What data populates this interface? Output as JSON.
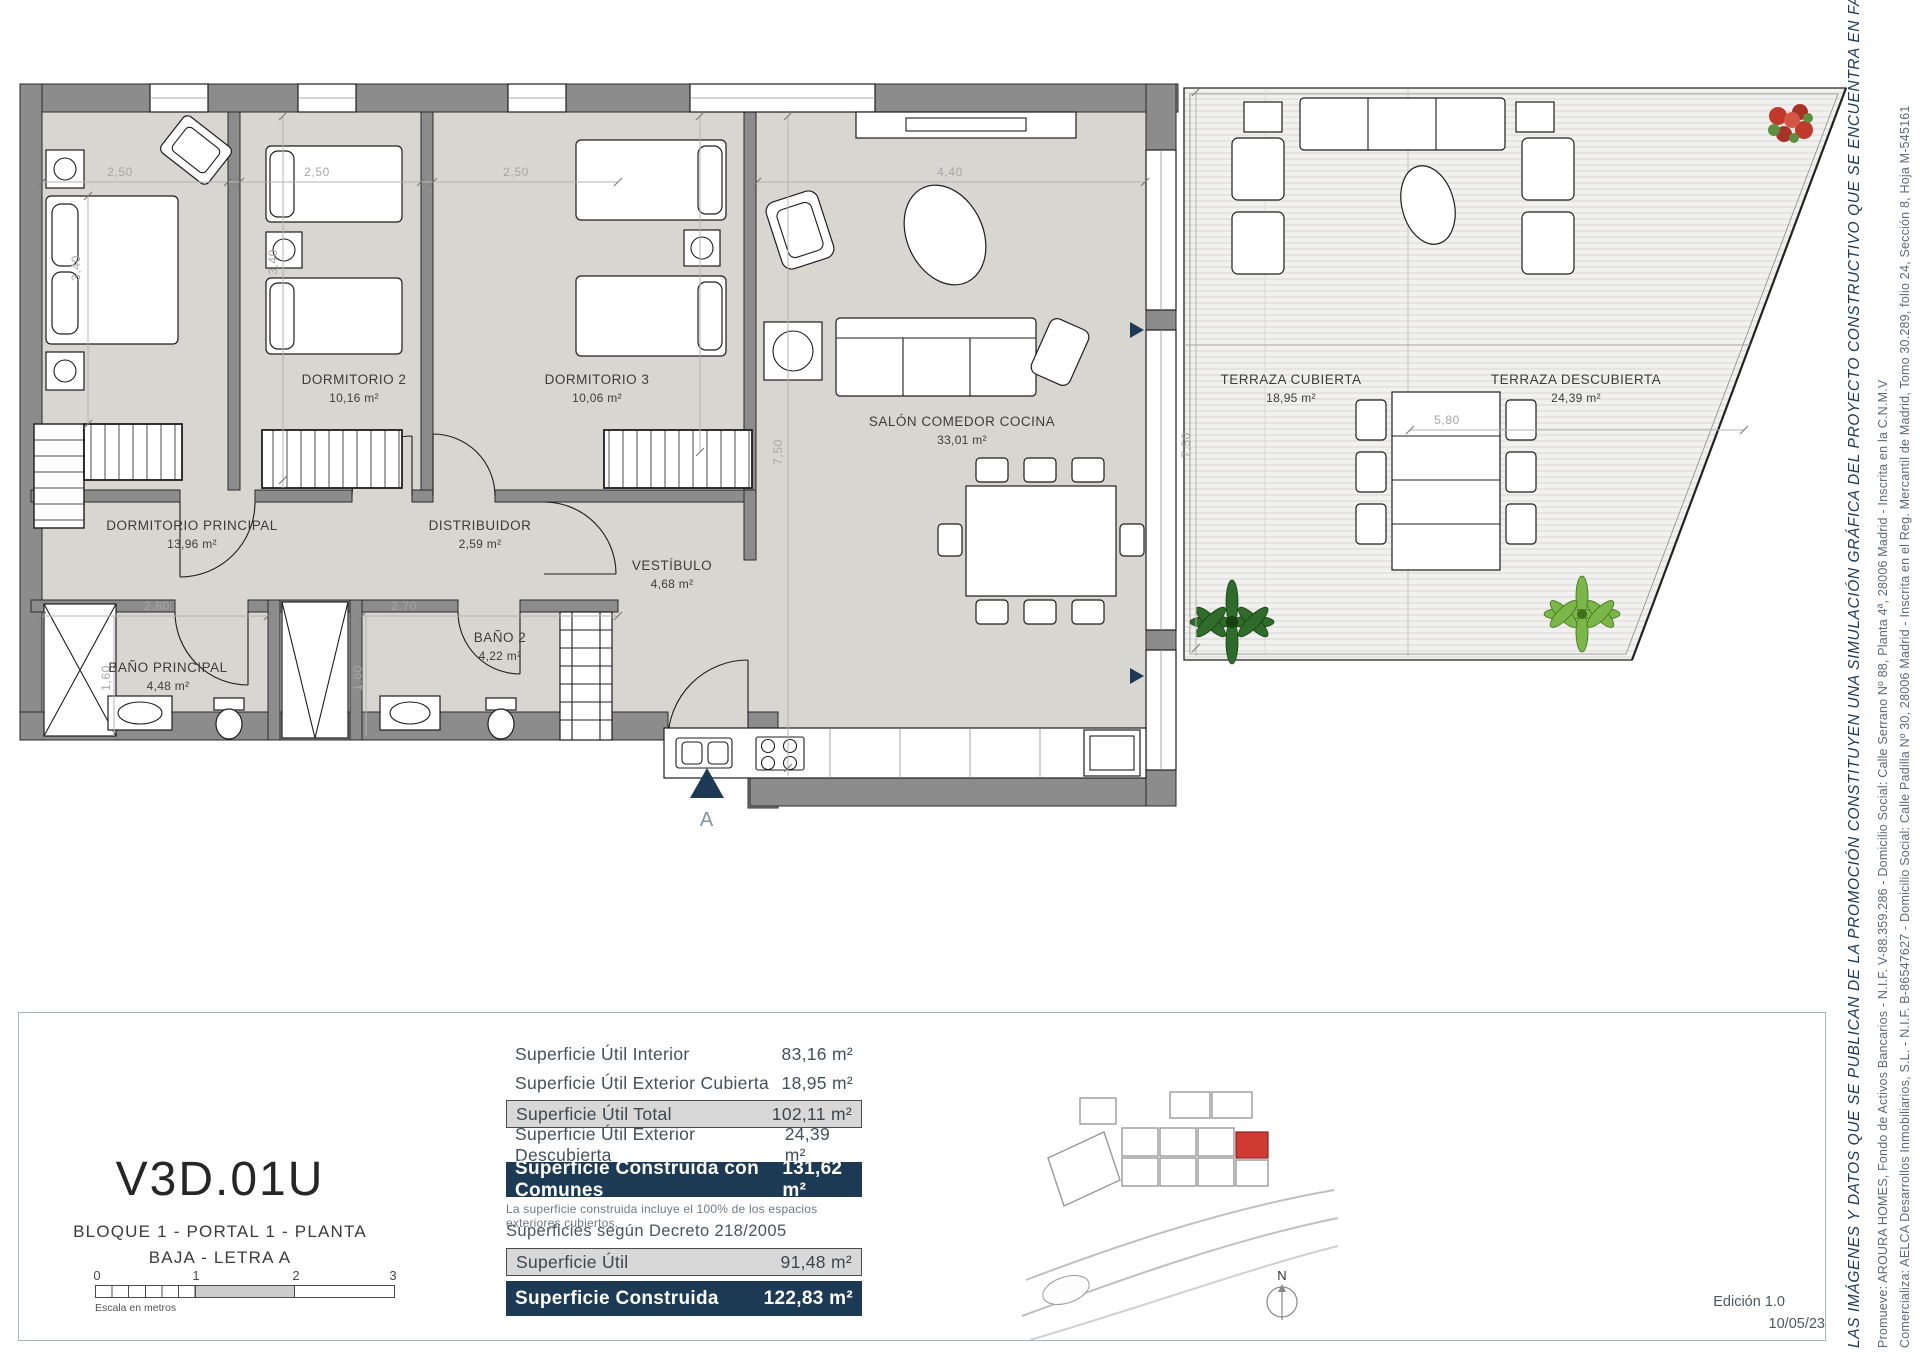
{
  "sheet": {
    "unit_code": "V3D.01U",
    "subtitle_line1": "BLOQUE 1 - PORTAL 1 - PLANTA",
    "subtitle_line2": "BAJA - LETRA A",
    "edition": "Edición 1.0",
    "date": "10/05/23"
  },
  "plan": {
    "rooms": [
      {
        "name": "DORMITORIO PRINCIPAL",
        "area": "13,96 m²"
      },
      {
        "name": "DORMITORIO 2",
        "area": "10,16 m²"
      },
      {
        "name": "DORMITORIO 3",
        "area": "10,06 m²"
      },
      {
        "name": "SALÓN COMEDOR COCINA",
        "area": "33,01 m²"
      },
      {
        "name": "DISTRIBUIDOR",
        "area": "2,59 m²"
      },
      {
        "name": "VESTÍBULO",
        "area": "4,68 m²"
      },
      {
        "name": "BAÑO PRINCIPAL",
        "area": "4,48 m²"
      },
      {
        "name": "BAÑO 2",
        "area": "4,22 m²"
      },
      {
        "name": "TERRAZA CUBIERTA",
        "area": "18,95 m²"
      },
      {
        "name": "TERRAZA DESCUBIERTA",
        "area": "24,39 m²"
      }
    ],
    "dims": {
      "d1": "2,50",
      "d2": "2,50",
      "d3": "2,50",
      "d4": "3,40",
      "d5": "3,40",
      "d6": "4,40",
      "d7": "7,50",
      "d8": "7,50",
      "d9": "5,80",
      "d10": "2,80",
      "d11": "2,70",
      "d12": "1,60",
      "d13": "1,60"
    },
    "entrance_label": "A"
  },
  "scalebar": {
    "ticks": [
      "0",
      "1",
      "2",
      "3"
    ],
    "caption": "Escala en metros"
  },
  "areas_table": {
    "rows": [
      {
        "label": "Superficie Útil Interior",
        "value": "83,16 m²"
      },
      {
        "label": "Superficie Útil Exterior Cubierta",
        "value": "18,95 m²"
      },
      {
        "label": "Superficie Útil Total",
        "value": "102,11 m²"
      },
      {
        "label": "Superficie Útil Exterior Descubierta",
        "value": "24,39 m²"
      },
      {
        "label": "Superficie Construida con Comunes",
        "value": "131,62 m²"
      }
    ],
    "footnote": "La superficie construida incluye el 100% de los espacios exteriores cubiertos."
  },
  "decreto_table": {
    "title": "Superficies según Decreto 218/2005",
    "rows": [
      {
        "label": "Superficie Útil",
        "value": "91,48 m²"
      },
      {
        "label": "Superficie Construida",
        "value": "122,83 m²"
      }
    ]
  },
  "compass": {
    "north": "N"
  },
  "legal": {
    "disclaimer": "LAS IMÁGENES Y DATOS QUE SE PUBLICAN DE LA PROMOCIÓN CONSTITUYEN UNA SIMULACIÓN GRÁFICA DEL PROYECTO CONSTRUCTIVO QUE SE ENCUENTRA EN FASE DE PROYECTO BÁSICO",
    "promoter": "Promueve: AROURA HOMES, Fondo de Activos Bancarios - N.I.F. V-88.359.286 - Domicilio Social: Calle Serrano Nº 88, Planta 4ª, 28006 Madrid - Inscrita en la C.N.M.V",
    "marketer": "Comercializa: AELCA Desarrollos Inmobiliarios, S.L. - N.I.F. B-86547627 - Domicilio Social: Calle Padilla Nº 30, 28006 Madrid - Inscrita en el Reg. Mercantil de Madrid, Tomo 30.289, folio 24, Sección 8, Hoja M-545161"
  },
  "colors": {
    "navy": "#1d3a55",
    "wall_gray": "#8c8c8c",
    "floor_gray": "#d8d6d0",
    "highlight_red": "#cf3a33"
  }
}
